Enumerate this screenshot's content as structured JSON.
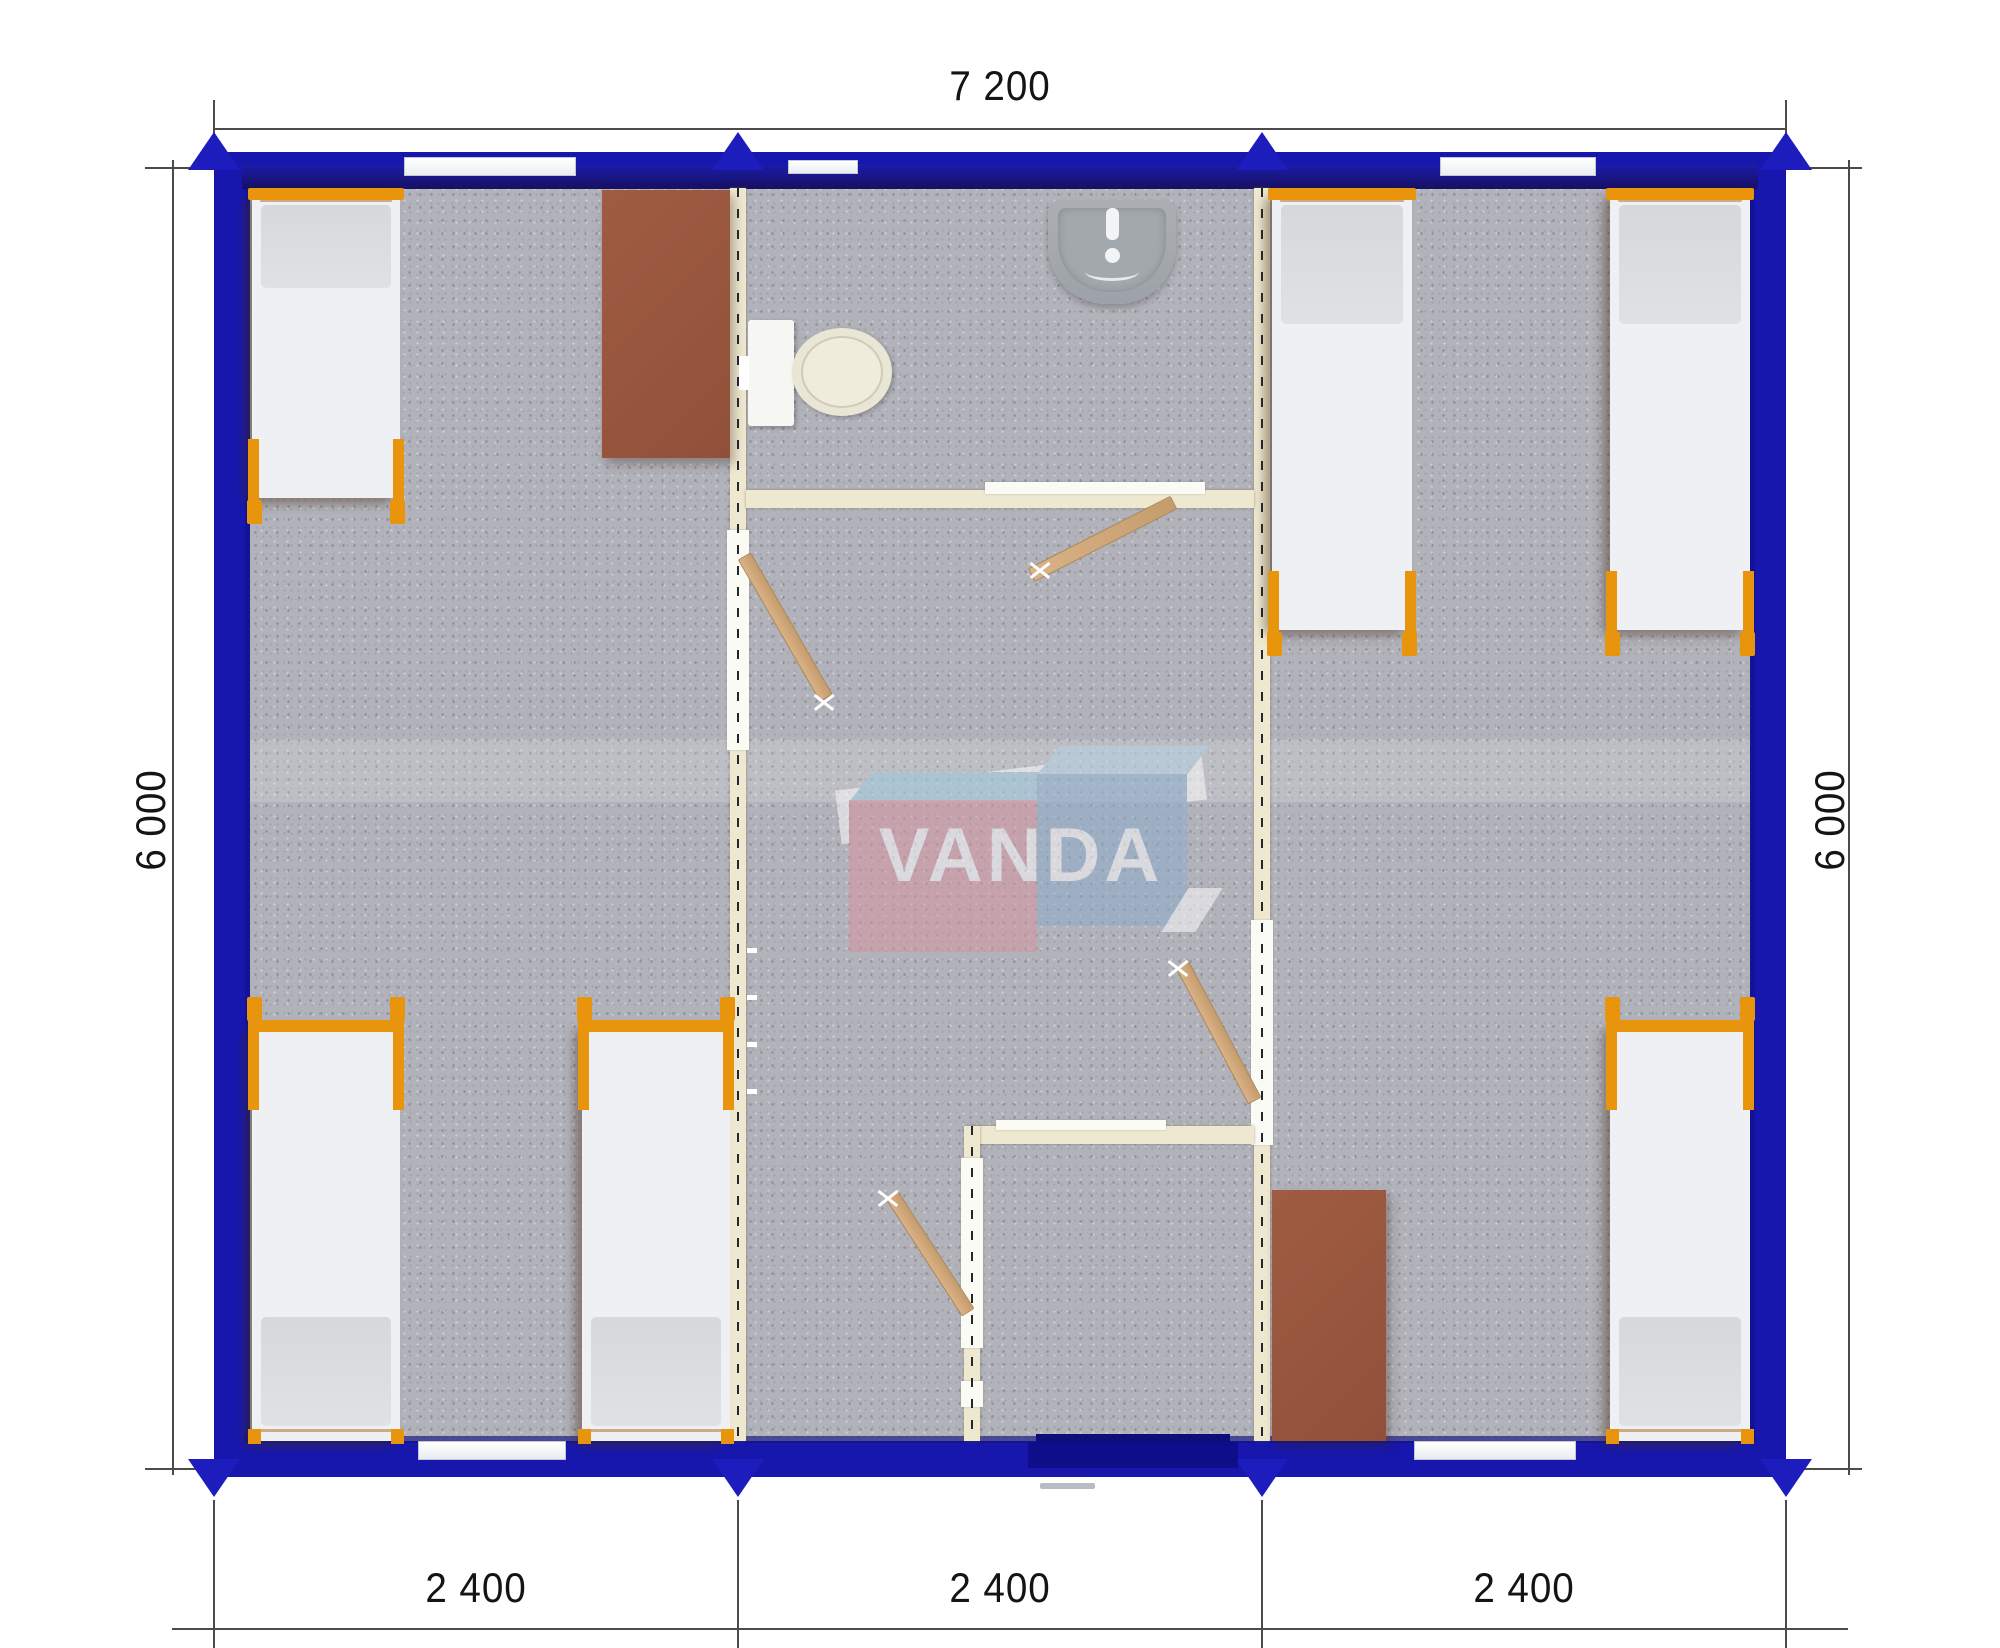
{
  "plan": {
    "dimensions": {
      "top": "7 200",
      "left": "6 000",
      "right": "6 000",
      "bottom": [
        "2 400",
        "2 400",
        "2 400"
      ]
    },
    "watermark": {
      "text": "VANDA"
    },
    "colors": {
      "exterior_wall_blue": "#1717ae",
      "interior_wall_cream": "#efe8d0",
      "floor_carpet_gray": "#b2b2ba",
      "bed_frame_orange": "#e8940c",
      "mattress_white": "#eef0f3",
      "desk_brown": "#9c5a40",
      "door_wood_tan": "#d2ab7c",
      "watermark_pink": "#d995a0",
      "watermark_blue": "#8cadcd",
      "dimension_text": "#141414"
    }
  }
}
